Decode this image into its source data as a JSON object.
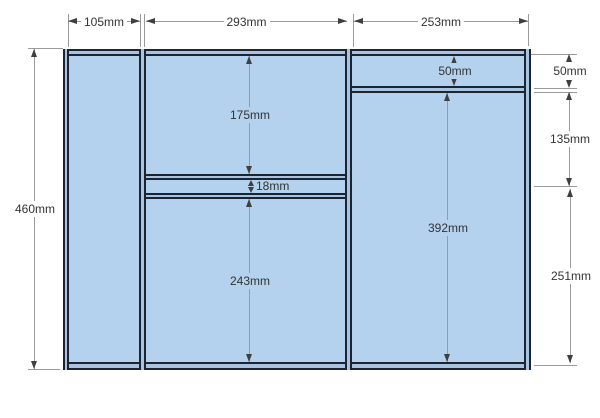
{
  "drawing": {
    "unit": "mm",
    "colors": {
      "panel_fill": "#b4d2ee",
      "panel_edge": "#1b2431",
      "wall_core": "#a9c4e0",
      "dim_line": "#9a9a9a",
      "arrow": "#3f3f3f",
      "text": "#333333",
      "background": "#ffffff"
    },
    "dims": {
      "top_widths": [
        {
          "name": "left-column-width",
          "label": "105mm"
        },
        {
          "name": "middle-column-width",
          "label": "293mm"
        },
        {
          "name": "right-column-width",
          "label": "253mm"
        }
      ],
      "overall_height": {
        "label": "460mm"
      },
      "middle_upper_height": {
        "label": "175mm"
      },
      "middle_gap_height": {
        "label": "18mm"
      },
      "middle_lower_height": {
        "label": "243mm"
      },
      "right_top_height": {
        "label": "50mm"
      },
      "right_main_height": {
        "label": "392mm"
      },
      "side_heights": [
        {
          "name": "side-top",
          "label": "50mm"
        },
        {
          "name": "side-middle",
          "label": "135mm"
        },
        {
          "name": "side-bottom",
          "label": "251mm"
        }
      ]
    }
  }
}
